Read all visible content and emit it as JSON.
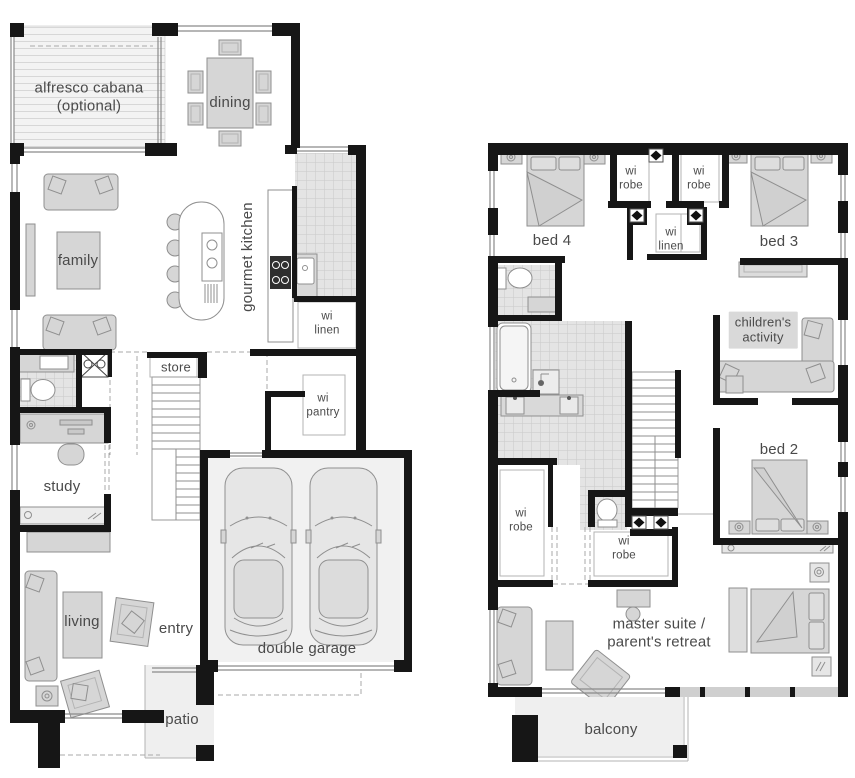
{
  "plan": {
    "ground_floor": {
      "alfresco": "alfresco cabana\n(optional)",
      "dining": "dining",
      "family": "family",
      "gourmet_kitchen": "gourmet kitchen",
      "wi_linen": "wi\nlinen",
      "store": "store",
      "wi_pantry": "wi\npantry",
      "study": "study",
      "living": "living",
      "entry": "entry",
      "double_garage": "double garage",
      "patio": "patio"
    },
    "first_floor": {
      "bed4": "bed 4",
      "wi_robe_top_left": "wi\nrobe",
      "wi_robe_top_right": "wi\nrobe",
      "bed3": "bed 3",
      "wi_linen": "wi\nlinen",
      "childrens_activity": "children's\nactivity",
      "bed2": "bed 2",
      "wi_robe_master_left": "wi\nrobe",
      "wi_robe_master_right": "wi\nrobe",
      "master_suite": "master suite /\nparent's retreat",
      "balcony": "balcony"
    },
    "colors": {
      "wall": "#161616",
      "furniture_fill": "#d6d6d6",
      "furniture_stroke": "#8f8f8f",
      "tile_fill": "#e4e4e4",
      "tile_line": "#c9c9c9",
      "slab_fill": "#efefef",
      "label_text": "#4a4a4a"
    }
  }
}
